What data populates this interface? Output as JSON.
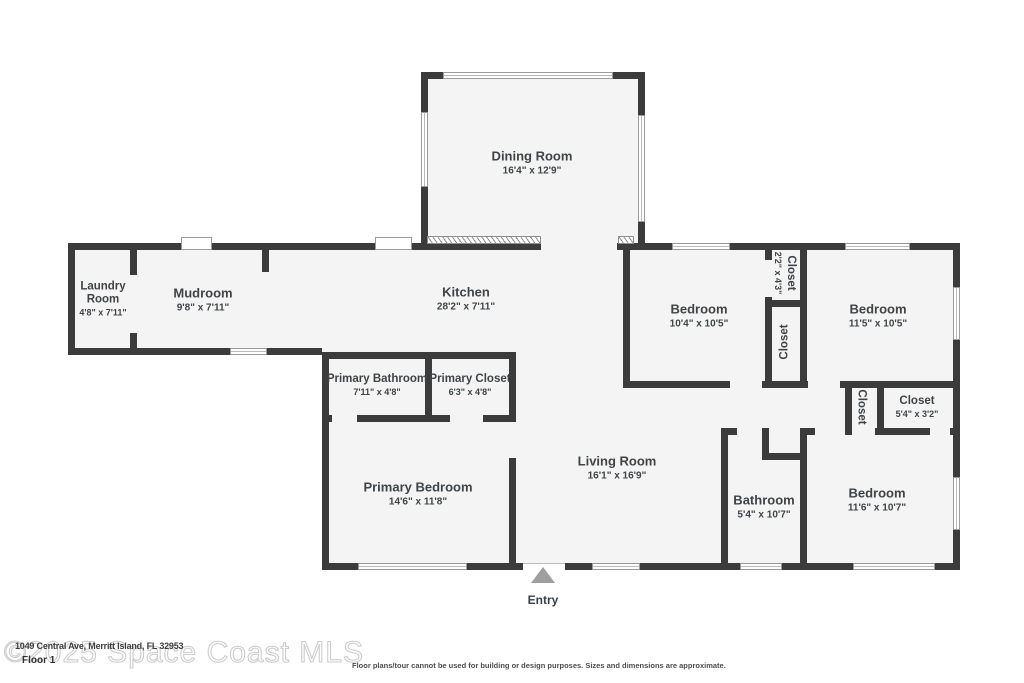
{
  "floor_label": "Floor 1",
  "watermark": "©2025 Space Coast MLS",
  "address_overlay": "1049 Central Ave, Merritt Island, FL 32953",
  "disclaimer": "Floor plans/tour cannot be used for building or design purposes. Sizes and dimensions are approximate.",
  "entry_label": "Entry",
  "colors": {
    "wall": "#3b3b3b",
    "room_fill": "#f4f4f4",
    "label_text": "#3f4449",
    "entry_arrow": "#9f9f9f",
    "watermark": "#cdcdcd"
  },
  "rooms": {
    "dining": {
      "name": "Dining Room",
      "dims": "16'4\" x 12'9\""
    },
    "laundry": {
      "name": "Laundry Room",
      "dims": "4'8\" x 7'11\""
    },
    "mudroom": {
      "name": "Mudroom",
      "dims": "9'8\" x 7'11\""
    },
    "kitchen": {
      "name": "Kitchen",
      "dims": "28'2\" x 7'11\""
    },
    "bedroom1": {
      "name": "Bedroom",
      "dims": "10'4\" x 10'5\""
    },
    "closet1": {
      "name": "Closet",
      "dims": "2'2\" x 4'3\""
    },
    "closet2": {
      "name": "Closet",
      "dims": ""
    },
    "bedroom2": {
      "name": "Bedroom",
      "dims": "11'5\" x 10'5\""
    },
    "primary_bathroom": {
      "name": "Primary Bathroom",
      "dims": "7'11\" x 4'8\""
    },
    "primary_closet": {
      "name": "Primary Closet",
      "dims": "6'3\" x 4'8\""
    },
    "primary_bedroom": {
      "name": "Primary Bedroom",
      "dims": "14'6\" x 11'8\""
    },
    "living": {
      "name": "Living Room",
      "dims": "16'1\" x 16'9\""
    },
    "closet3": {
      "name": "Closet",
      "dims": ""
    },
    "closet4": {
      "name": "Closet",
      "dims": "5'4\" x 3'2\""
    },
    "bathroom": {
      "name": "Bathroom",
      "dims": "5'4\" x 10'7\""
    },
    "bedroom3": {
      "name": "Bedroom",
      "dims": "11'6\" x 10'7\""
    }
  }
}
